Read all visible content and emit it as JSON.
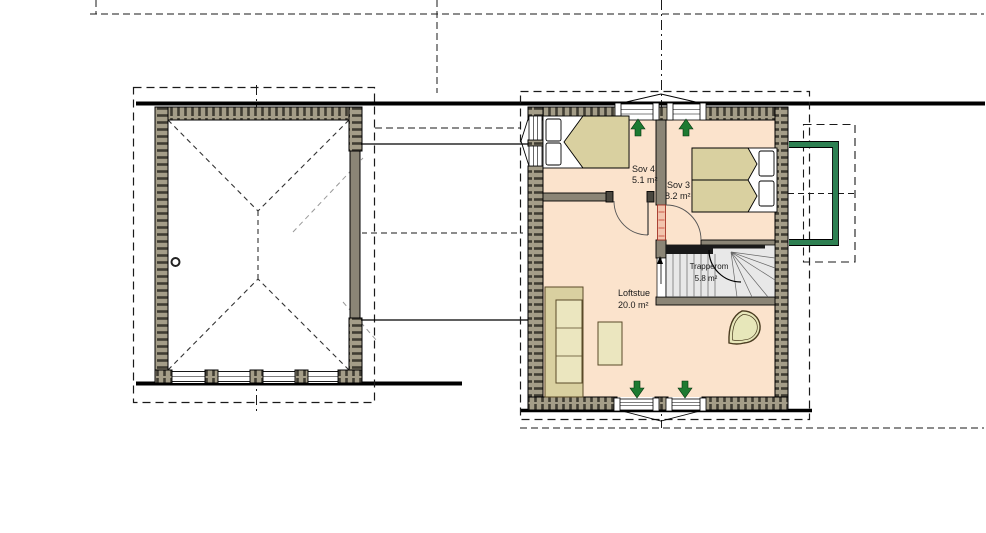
{
  "plan": {
    "type": "floor-plan",
    "buildings": [
      "garage",
      "house-loft-level"
    ]
  },
  "rooms": {
    "sov4": {
      "name": "Sov 4",
      "area": "5.1 m²"
    },
    "sov3": {
      "name": "Sov 3",
      "area": "8.2 m²"
    },
    "loftstue": {
      "name": "Loftstue",
      "area": "20.0 m²"
    },
    "trapperom": {
      "name": "Trapperom",
      "area": "5.8 m²"
    }
  },
  "icons": [
    "up-arrow",
    "up-arrow",
    "down-arrow",
    "down-arrow"
  ],
  "colors": {
    "floor": "#fbe3cc",
    "wall_fill": "#a49d88",
    "wall_tick": "#403d33",
    "interior_wall": "#8b8576",
    "furniture_tan": "#d9d0a0",
    "furniture_light": "#ebe6bf",
    "stair_gray": "#e8e8e8",
    "arrow_green": "#1d7a31",
    "railing_green": "#2e8052",
    "door_leaf_red": "#f2c4ad"
  }
}
